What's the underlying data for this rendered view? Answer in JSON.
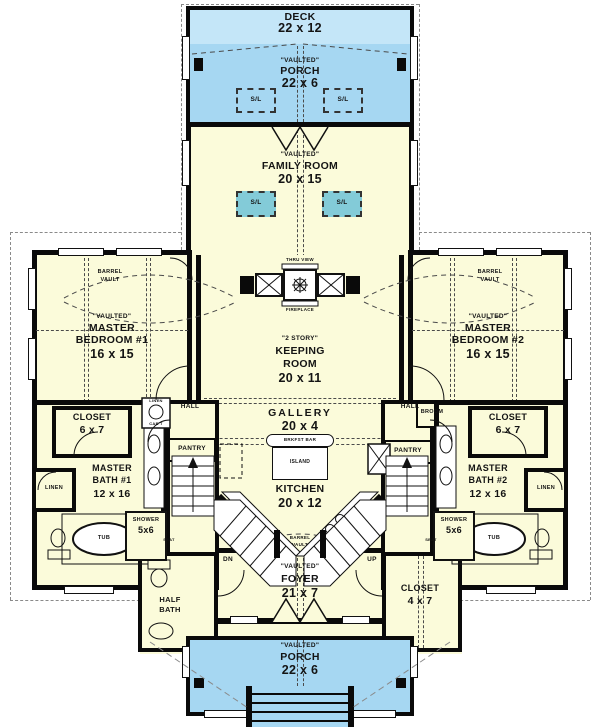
{
  "colors": {
    "floor": "#FBFBDA",
    "porch_blue": "#A6D7F2",
    "deck_blue": "#C4E6F8",
    "skylight_teal": "#83CBD8",
    "wall": "#0A0A0A"
  },
  "rooms": {
    "deck": {
      "name": "DECK",
      "dims": "22 x 12"
    },
    "porch_top": {
      "note": "\"VAULTED\"",
      "name": "PORCH",
      "dims": "22 x 6"
    },
    "family_room": {
      "note": "\"VAULTED\"",
      "name": "FAMILY ROOM",
      "dims": "20 x 15"
    },
    "master_bedroom_1": {
      "note": "\"VAULTED\"",
      "name": "MASTER",
      "name2": "BEDROOM #1",
      "dims": "16 x 15"
    },
    "master_bedroom_2": {
      "note": "\"VAULTED\"",
      "name": "MASTER",
      "name2": "BEDROOM #2",
      "dims": "16 x 15"
    },
    "keeping_room": {
      "note": "\"2 STORY\"",
      "name": "KEEPING",
      "name2": "ROOM",
      "dims": "20 x 11"
    },
    "gallery": {
      "name": "GALLERY",
      "dims": "20 x 4"
    },
    "kitchen": {
      "name": "KITCHEN",
      "dims": "20 x 12"
    },
    "master_bath_1": {
      "name": "MASTER",
      "name2": "BATH #1",
      "dims": "12 x 16"
    },
    "master_bath_2": {
      "name": "MASTER",
      "name2": "BATH #2",
      "dims": "12 x 16"
    },
    "closet_1": {
      "name": "CLOSET",
      "dims": "6 x 7"
    },
    "closet_2": {
      "name": "CLOSET",
      "dims": "6 x 7"
    },
    "foyer": {
      "note": "\"VAULTED\"",
      "name": "FOYER",
      "dims": "21 x 7"
    },
    "foyer_closet": {
      "name": "CLOSET",
      "dims": "4 x 7"
    },
    "half_bath": {
      "name": "HALF",
      "name2": "BATH"
    },
    "porch_bottom": {
      "note": "\"VAULTED\"",
      "name": "PORCH",
      "dims": "22 x 6"
    }
  },
  "features": {
    "skylight": "S/L",
    "barrel_vault_line1": "BARREL",
    "barrel_vault_line2": "VAULT",
    "fireplace_line1": "THRU VIEW",
    "fireplace_line2": "FIREPLACE",
    "breakfast_bar": "BRKFST BAR",
    "island": "ISLAND",
    "hall": "HALL",
    "pantry": "PANTRY",
    "broom": "BROOM",
    "linen": "LINEN",
    "linen_cabinet_line1": "LINEN",
    "linen_cabinet_line2": "CAB'T",
    "tub": "TUB",
    "shower": "SHOWER",
    "shower_dims": "5x6",
    "seat": "SEAT",
    "down": "DN",
    "up": "UP"
  }
}
